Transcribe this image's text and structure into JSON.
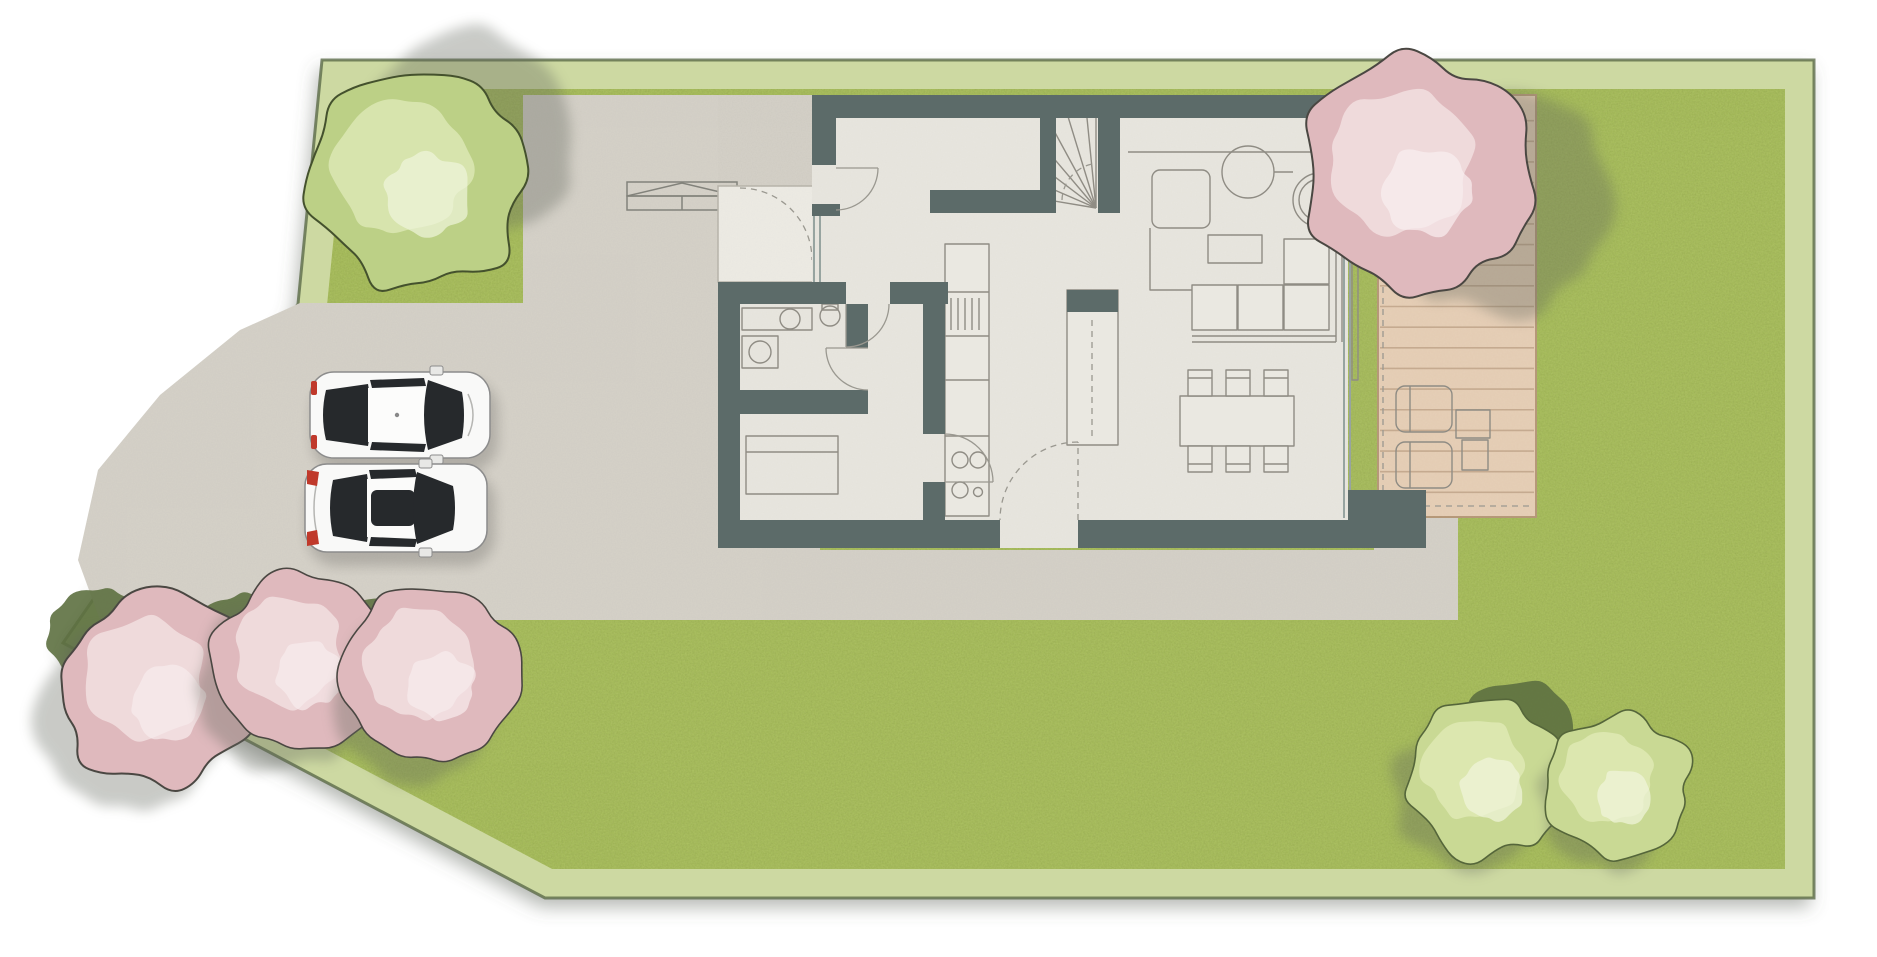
{
  "meta": {
    "description": "Top-down architectural site plan: ground floor of a house with garden, wooden terrace, concrete driveway, trees and two parked cars",
    "view": "top-down",
    "visible_text": []
  },
  "palette": {
    "background": "#ffffff",
    "grass": "#a3bb56",
    "grass_band": "#cdd9a2",
    "boundary_line": "#5d6b4a",
    "concrete": "#d6d2c9",
    "house_floor": "#e8e6df",
    "wall": "#5c6b69",
    "deck_wood": "#e6cfb7",
    "deck_line": "#a5876a",
    "furniture_line": "#8f8c84",
    "door_line": "#9a9890",
    "tree_green": "#bcd086",
    "tree_green_light": "#dce8b4",
    "tree_pink": "#dfb9bd",
    "tree_pink_light": "#f2dfe1",
    "bush_green": "#c9d994",
    "bush_dark": "#5d7040",
    "car_glass": "#26292c",
    "car_red": "#c0392b",
    "shadow": "#62665c"
  },
  "site": {
    "vegetation": [
      {
        "name": "bush-dark-1",
        "type": "bush-dark",
        "cx": 96,
        "cy": 630,
        "r": 48,
        "seed": 21
      },
      {
        "name": "bush-dark-2",
        "type": "bush-dark",
        "cx": 244,
        "cy": 638,
        "r": 46,
        "seed": 22
      },
      {
        "name": "bush-dark-3",
        "type": "bush-dark",
        "cx": 374,
        "cy": 636,
        "r": 42,
        "seed": 23
      },
      {
        "name": "shrub-pink-1",
        "type": "shrub-pink",
        "cx": 160,
        "cy": 690,
        "r": 97,
        "seed": 31,
        "shadow": [
          -26,
          28
        ]
      },
      {
        "name": "shrub-pink-2",
        "type": "shrub-pink",
        "cx": 302,
        "cy": 662,
        "r": 88,
        "seed": 32,
        "shadow": [
          -20,
          24
        ]
      },
      {
        "name": "shrub-pink-3",
        "type": "shrub-pink",
        "cx": 434,
        "cy": 674,
        "r": 88,
        "seed": 33,
        "shadow": [
          -16,
          24
        ]
      },
      {
        "name": "bush-dark-4",
        "type": "bush-dark",
        "cx": 1524,
        "cy": 736,
        "r": 58,
        "seed": 24
      },
      {
        "name": "bush-green-1",
        "type": "bush-green",
        "cx": 1486,
        "cy": 778,
        "r": 80,
        "seed": 41,
        "shadow": [
          -14,
          16
        ]
      },
      {
        "name": "bush-green-2",
        "type": "bush-green",
        "cx": 1618,
        "cy": 786,
        "r": 72,
        "seed": 42,
        "shadow": [
          -12,
          14
        ]
      },
      {
        "name": "tree-green-large",
        "type": "canopy-green",
        "cx": 418,
        "cy": 180,
        "r": 110,
        "seed": 3,
        "shadow": [
          52,
          -42
        ]
      },
      {
        "name": "tree-pink-large",
        "type": "canopy-pink",
        "cx": 1418,
        "cy": 175,
        "r": 116,
        "seed": 11,
        "shadow": [
          80,
          26
        ]
      }
    ],
    "cars": [
      {
        "name": "car-hatchback-white",
        "color": "white",
        "orientation": "front-right"
      },
      {
        "name": "car-sedan-white",
        "color": "white",
        "orientation": "front-right"
      }
    ],
    "driveway": {
      "surface": "concrete"
    },
    "bike_shelter": {
      "present": true
    }
  },
  "house": {
    "rooms": [
      {
        "name": "entrance-hall"
      },
      {
        "name": "staircase"
      },
      {
        "name": "wc-bathroom"
      },
      {
        "name": "storage-room"
      },
      {
        "name": "corridor"
      },
      {
        "name": "kitchen"
      },
      {
        "name": "living-dining-room"
      }
    ],
    "furniture": [
      "sofa-l-shaped",
      "coffee-table",
      "armchair-round",
      "swivel-chair",
      "side-table",
      "dining-table",
      "dining-chairs-6",
      "kitchen-counter",
      "cooktop",
      "kitchen-island",
      "toilet",
      "washbasin",
      "vanity-counter",
      "wardrobe"
    ],
    "doors": [
      "front-door",
      "wc-door",
      "hall-door",
      "kitchen-door",
      "patio-door"
    ],
    "terrace": {
      "material": "wood-planks",
      "plank_count": 20,
      "furniture": [
        "sun-lounger",
        "sun-lounger",
        "deck-side-table"
      ]
    }
  }
}
